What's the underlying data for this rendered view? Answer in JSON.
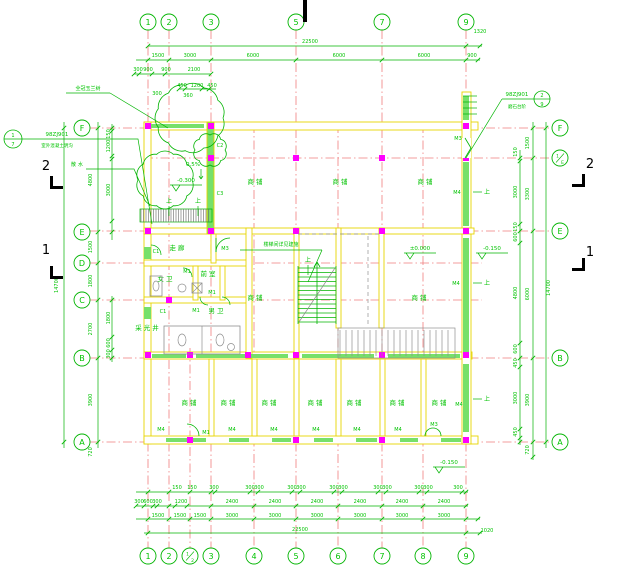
{
  "title": "first-floor architectural plan",
  "colors": {
    "line_green": "#00b400",
    "text_green": "#00c300",
    "grid_red": "#f07e7e",
    "wall_yellow": "#e8d400",
    "window_green": "#76e06a",
    "column_magenta": "#ff00ff",
    "gray": "#8f8f8f",
    "black": "#000000"
  },
  "bubbles": {
    "top_y": 22,
    "bottom_y": 556,
    "left_x": 82,
    "right_x": 560,
    "top": [
      [
        "1",
        148
      ],
      [
        "2",
        169
      ],
      [
        "3",
        211
      ],
      [
        "5",
        296
      ],
      [
        "7",
        382
      ],
      [
        "9",
        466
      ]
    ],
    "bottom": [
      [
        "1",
        148
      ],
      [
        "2",
        169
      ],
      [
        "1/2",
        190
      ],
      [
        "3",
        211
      ],
      [
        "4",
        254
      ],
      [
        "5",
        296
      ],
      [
        "6",
        338
      ],
      [
        "7",
        382
      ],
      [
        "8",
        423
      ],
      [
        "9",
        466
      ]
    ],
    "left": [
      [
        "F",
        128
      ],
      [
        "E",
        232
      ],
      [
        "D",
        263
      ],
      [
        "C",
        300
      ],
      [
        "B",
        358
      ],
      [
        "A",
        442
      ]
    ],
    "right": [
      [
        "F",
        128
      ],
      [
        "1/E",
        158
      ],
      [
        "E",
        231
      ],
      [
        "B",
        358
      ],
      [
        "A",
        442
      ]
    ]
  },
  "dims": {
    "top": [
      [
        "22500",
        310,
        43
      ],
      [
        "1320",
        480,
        33
      ],
      [
        "1500",
        158,
        57
      ],
      [
        "3000",
        190,
        57
      ],
      [
        "6000",
        253,
        57
      ],
      [
        "6000",
        339,
        57
      ],
      [
        "6000",
        424,
        57
      ],
      [
        "900",
        472,
        57
      ],
      [
        "300",
        138,
        71
      ],
      [
        "900",
        148,
        71
      ],
      [
        "900",
        166,
        71
      ],
      [
        "2100",
        194,
        71
      ],
      [
        "450",
        182,
        87
      ],
      [
        "1200",
        197,
        87
      ],
      [
        "450",
        212,
        87
      ],
      [
        "360",
        188,
        97
      ],
      [
        "300",
        157,
        95
      ]
    ],
    "bottom": [
      [
        "150",
        177,
        489
      ],
      [
        "150",
        192,
        489
      ],
      [
        "300",
        214,
        489
      ],
      [
        "300",
        250,
        489
      ],
      [
        "300",
        259,
        489
      ],
      [
        "300",
        292,
        489
      ],
      [
        "300",
        301,
        489
      ],
      [
        "300",
        334,
        489
      ],
      [
        "300",
        343,
        489
      ],
      [
        "300",
        378,
        489
      ],
      [
        "300",
        387,
        489
      ],
      [
        "300",
        419,
        489
      ],
      [
        "300",
        428,
        489
      ],
      [
        "300",
        458,
        489
      ],
      [
        "300",
        139,
        503
      ],
      [
        "600",
        148,
        503
      ],
      [
        "300",
        157,
        503
      ],
      [
        "1200",
        181,
        503
      ],
      [
        "2400",
        232,
        503
      ],
      [
        "2400",
        275,
        503
      ],
      [
        "2400",
        317,
        503
      ],
      [
        "2400",
        360,
        503
      ],
      [
        "2400",
        402,
        503
      ],
      [
        "2400",
        444,
        503
      ],
      [
        "1500",
        158,
        517
      ],
      [
        "1500",
        180,
        517
      ],
      [
        "1500",
        200,
        517
      ],
      [
        "3000",
        232,
        517
      ],
      [
        "3000",
        275,
        517
      ],
      [
        "3000",
        317,
        517
      ],
      [
        "3000",
        360,
        517
      ],
      [
        "3000",
        402,
        517
      ],
      [
        "3000",
        444,
        517
      ],
      [
        "22500",
        300,
        531
      ],
      [
        "1020",
        487,
        532
      ]
    ],
    "left": [
      [
        "14700",
        58,
        285
      ],
      [
        "4800",
        92,
        180
      ],
      [
        "1500",
        92,
        247
      ],
      [
        "1800",
        92,
        281
      ],
      [
        "2700",
        92,
        329
      ],
      [
        "3900",
        92,
        400
      ],
      [
        "150",
        110,
        134
      ],
      [
        "1200",
        110,
        146
      ],
      [
        "3000",
        110,
        190
      ],
      [
        "1800",
        110,
        318
      ],
      [
        "600",
        110,
        343
      ],
      [
        "300",
        110,
        354
      ],
      [
        "720",
        92,
        452
      ]
    ],
    "right": [
      [
        "14700",
        550,
        288
      ],
      [
        "1500",
        529,
        143
      ],
      [
        "3300",
        529,
        194
      ],
      [
        "6000",
        529,
        294
      ],
      [
        "3900",
        529,
        400
      ],
      [
        "150",
        517,
        152
      ],
      [
        "3000",
        517,
        192
      ],
      [
        "150",
        517,
        227
      ],
      [
        "600",
        517,
        237
      ],
      [
        "4800",
        517,
        293
      ],
      [
        "600",
        517,
        349
      ],
      [
        "450",
        517,
        363
      ],
      [
        "3000",
        517,
        398
      ],
      [
        "450",
        517,
        432
      ],
      [
        "720",
        529,
        450
      ]
    ]
  },
  "rooms": [
    [
      "商铺",
      256,
      184
    ],
    [
      "商铺",
      341,
      184
    ],
    [
      "商铺",
      426,
      184
    ],
    [
      "商铺",
      256,
      300
    ],
    [
      "商铺",
      420,
      300
    ],
    [
      "商铺",
      190,
      405
    ],
    [
      "商铺",
      229,
      405
    ],
    [
      "商铺",
      270,
      405
    ],
    [
      "商铺",
      316,
      405
    ],
    [
      "商铺",
      355,
      405
    ],
    [
      "商铺",
      398,
      405
    ],
    [
      "商铺",
      440,
      405
    ],
    [
      "走廊",
      178,
      250
    ],
    [
      "前室",
      209,
      276
    ],
    [
      "男卫",
      217,
      313
    ],
    [
      "女卫",
      166,
      281
    ],
    [
      "采光井",
      148,
      330
    ]
  ],
  "tags": [
    [
      "C2",
      220,
      147
    ],
    [
      "C3",
      220,
      195
    ],
    [
      "C1",
      156,
      253
    ],
    [
      "C1",
      163,
      313
    ],
    [
      "M1",
      187,
      273
    ],
    [
      "M1",
      212,
      294
    ],
    [
      "M1",
      196,
      312
    ],
    [
      "M1",
      206,
      434
    ],
    [
      "M3",
      225,
      250
    ],
    [
      "M3",
      458,
      140
    ],
    [
      "M3",
      434,
      426
    ],
    [
      "M4",
      457,
      194
    ],
    [
      "M4",
      456,
      285
    ],
    [
      "M4",
      459,
      406
    ],
    [
      "M4",
      161,
      431
    ],
    [
      "M4",
      232,
      431
    ],
    [
      "M4",
      274,
      431
    ],
    [
      "M4",
      316,
      431
    ],
    [
      "M4",
      357,
      431
    ],
    [
      "M4",
      398,
      431
    ]
  ],
  "levels": [
    [
      "±0.000",
      420,
      250
    ],
    [
      "-0.150",
      492,
      250
    ],
    [
      "-0.150",
      449,
      464
    ],
    [
      "-0.300",
      186,
      182
    ]
  ],
  "slope": [
    "0.5%",
    193,
    166
  ],
  "up_label": "上",
  "up_marks": [
    [
      169,
      203
    ],
    [
      198,
      203
    ],
    [
      308,
      262
    ],
    [
      487,
      194
    ],
    [
      487,
      285
    ],
    [
      487,
      401
    ]
  ],
  "notes": {
    "tree": [
      "全冠玉兰树",
      88,
      90
    ],
    "apron": [
      "散水",
      78,
      166
    ],
    "stair": [
      "楼梯间详见建施",
      281,
      246
    ]
  },
  "details": {
    "left": {
      "code": "98ZJ901",
      "num": "1",
      "den": "7",
      "desc": "室外混凝土明沟",
      "cx": 13,
      "cy": 139
    },
    "right": {
      "code": "98ZJ901",
      "num": "2",
      "den": "9",
      "desc": "磨石台阶",
      "cx": 542,
      "cy": 99
    }
  },
  "sections": [
    [
      "2",
      46,
      170,
      "left",
      50,
      176
    ],
    [
      "1",
      46,
      254,
      "left",
      50,
      266
    ],
    [
      "2",
      590,
      168,
      "right",
      582,
      174
    ],
    [
      "1",
      590,
      256,
      "right",
      582,
      258
    ]
  ]
}
